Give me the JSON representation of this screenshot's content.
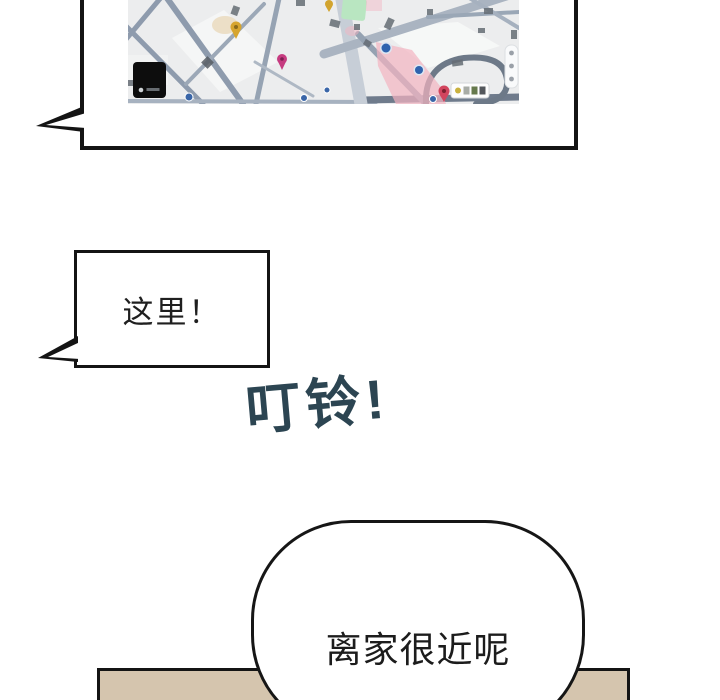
{
  "page": {
    "width": 720,
    "height": 700
  },
  "bubbles": {
    "here": {
      "text": "这里！"
    },
    "near_home": {
      "text": "离家很近呢"
    }
  },
  "sfx": {
    "text": "叮铃!"
  },
  "colors": {
    "outline": "#141414",
    "sfx_text": "#2c4552",
    "panel_beige": "#d5c5ae",
    "map_bg": "#ecedee",
    "map_road": "#8e9bad",
    "map_road_light": "#c7ced7",
    "map_green": "#b9e6c1",
    "map_pink": "#f3b4c1",
    "pin_yellow": "#d7a52e",
    "pin_magenta": "#c63b80",
    "pin_red": "#d2455e",
    "marker_blue": "#2f63ae",
    "map_logo": "#0d0d0d"
  }
}
